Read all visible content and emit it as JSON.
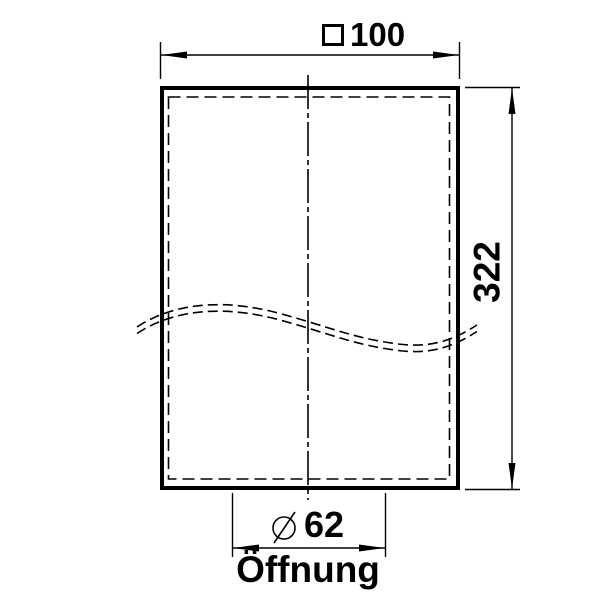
{
  "drawing": {
    "type": "technical-dimension-drawing",
    "part": "rectangular shade / body with opening",
    "colors": {
      "line": "#000000",
      "background": "#ffffff"
    },
    "width_dimension": {
      "symbol": "square-icon",
      "symbol_meaning": "square cross-section",
      "value": "100"
    },
    "height_dimension": {
      "value": "322"
    },
    "opening_dimension": {
      "symbol": "diameter-icon",
      "symbol_meaning": "diameter",
      "value": "62",
      "label": "Öffnung"
    }
  }
}
